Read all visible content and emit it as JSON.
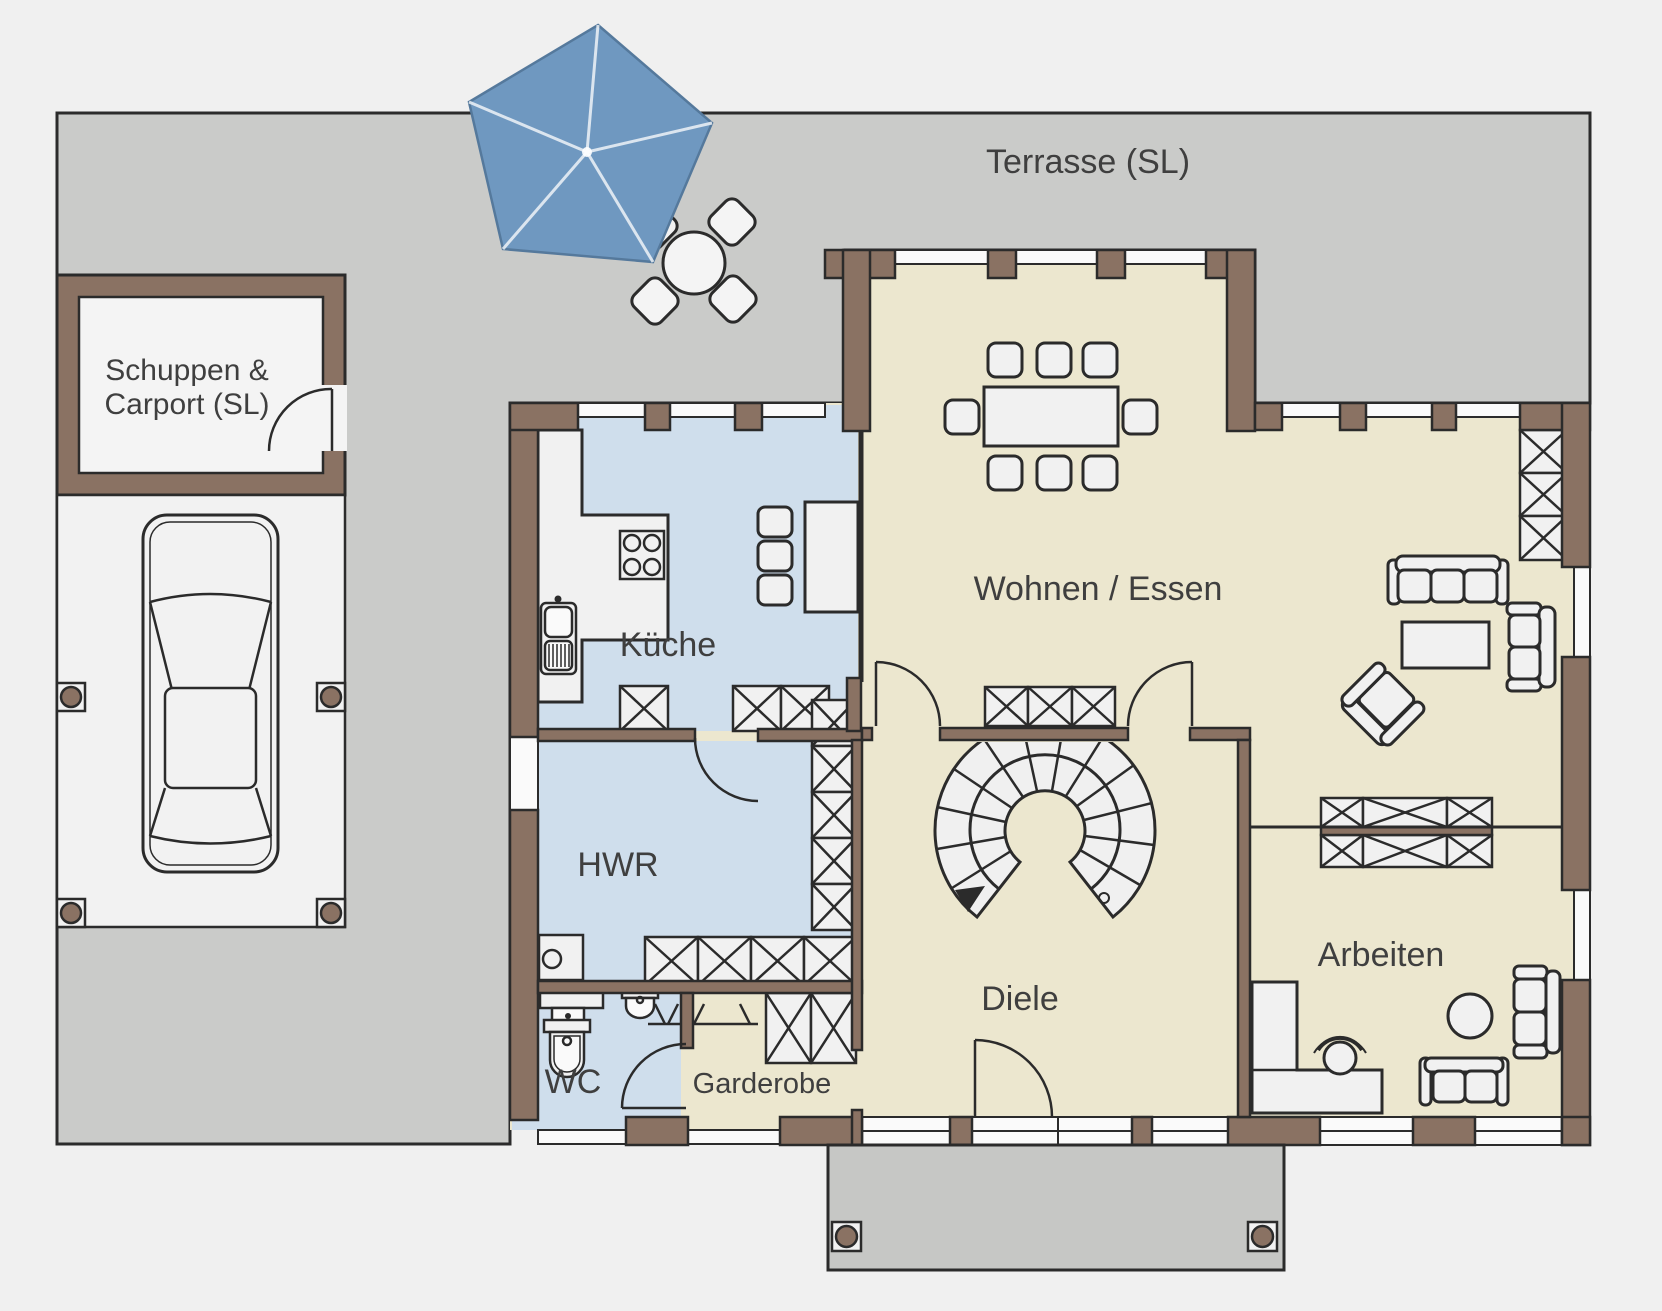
{
  "plan": {
    "title": "Erdgeschoss Grundriss",
    "labels": {
      "terrace": "Terrasse (SL)",
      "shed_line1": "Schuppen &",
      "shed_line2": "Carport (SL)",
      "kitchen": "Küche",
      "utility": "HWR",
      "wc": "WC",
      "wardrobe": "Garderobe",
      "living": "Wohnen / Essen",
      "hall": "Diele",
      "office": "Arbeiten"
    },
    "colors": {
      "background": "#f0f0f0",
      "terrace": "#cacbc9",
      "porch": "#c6c7c5",
      "wall": "#8a7263",
      "room_warm": "#ece7cf",
      "room_cool": "#cfdeec",
      "furniture": "#f1f1f1",
      "outline": "#2b2b2b",
      "umbrella": "#6f98c0",
      "text": "#3f3f3f"
    }
  }
}
